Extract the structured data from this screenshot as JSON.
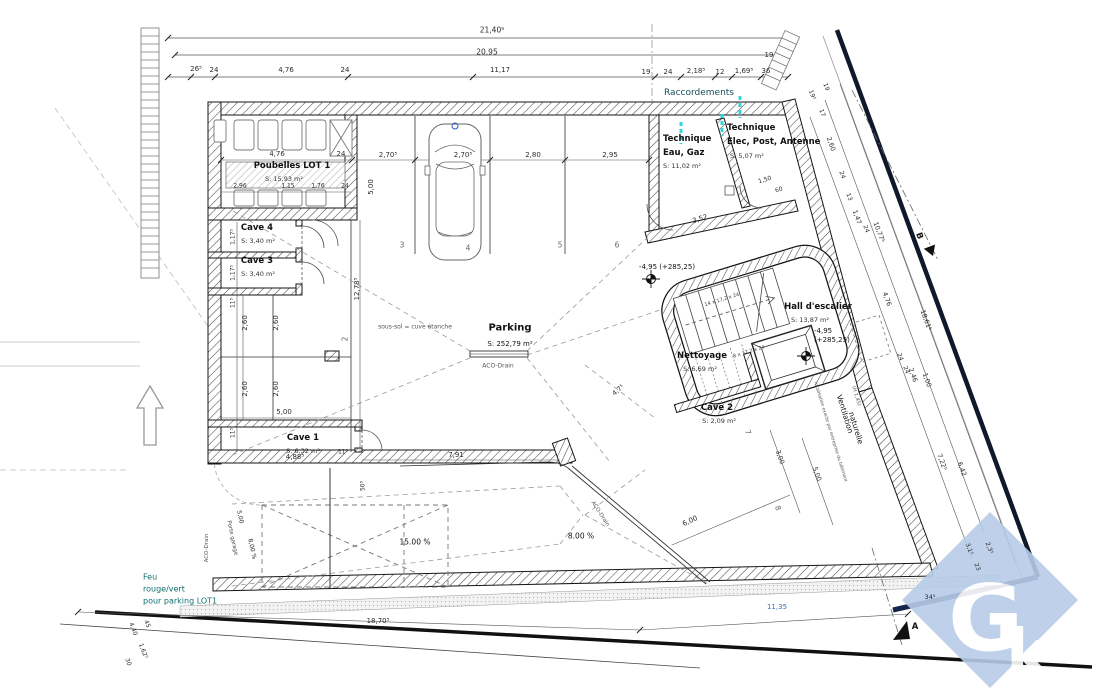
{
  "rooms": {
    "poubelles": {
      "name": "Poubelles LOT 1",
      "area": "S: 15,93 m²"
    },
    "cave4": {
      "name": "Cave 4",
      "area": "S: 3,40 m²"
    },
    "cave3": {
      "name": "Cave 3",
      "area": "S: 3,40 m²"
    },
    "cave1": {
      "name": "Cave 1",
      "area": "S: 6,32 m²"
    },
    "cave2": {
      "name": "Cave 2",
      "area": "S: 2,09 m²"
    },
    "parking": {
      "name": "Parking",
      "area": "S: 252,79 m²"
    },
    "technique_eau": {
      "name_line1": "Technique",
      "name_line2": "Eau, Gaz",
      "area": "S: 11,02 m²"
    },
    "technique_elec": {
      "name_line1": "Technique",
      "name_line2": "Elec, Post, Antenne",
      "area": "S: 5,07 m²"
    },
    "hall": {
      "name": "Hall d'escalier",
      "area": "S: 13,87 m²"
    },
    "nettoyage": {
      "name": "Nettoyage",
      "area": "S: 6,69 m²"
    }
  },
  "annotations": {
    "raccordements": "Raccordements",
    "feu_line1": "Feu",
    "feu_line2": "rouge/vert",
    "feu_line3": "pour parking LOT1",
    "sous_sol": "sous-sol = cuve étanche",
    "aco_drain": "ACO-Drain",
    "ventilation_line1": "Ventilation",
    "ventilation_line2": "naturelle",
    "ventilation_note": "localisation exacte par entreprise du bâtiment",
    "hauteur_note": "(H 1,45)",
    "porte_garage": "Porte garage",
    "stair_flight_upper": "14 x 17,2 x 24",
    "stair_flight_lower": "8 x 17,2 x 24",
    "level_left": "-4,95 (+285,25)",
    "level_right_line1": "-4,95",
    "level_right_line2": "(+285,25)",
    "slope_main": "15.00 %",
    "slope_secondary": "8.00 %",
    "section_a": "A",
    "section_b": "B"
  },
  "logo": {
    "letter1": "G",
    "letter2": "k",
    "color": "#b7cce8"
  },
  "colors": {
    "cyan_accent": "#35d3e0",
    "teal_text": "#0e6e6e",
    "dim_blue": "#3a6fae",
    "logo_blue": "#b7cce8"
  },
  "stall_numbers": [
    {
      "t": "2",
      "x": 345,
      "y": 339,
      "r": -90
    },
    {
      "t": "3",
      "x": 402,
      "y": 245
    },
    {
      "t": "4",
      "x": 468,
      "y": 248
    },
    {
      "t": "5",
      "x": 560,
      "y": 245
    },
    {
      "t": "6",
      "x": 617,
      "y": 245
    },
    {
      "t": "7",
      "x": 748,
      "y": 432,
      "r": 70
    },
    {
      "t": "8",
      "x": 778,
      "y": 508,
      "r": 70
    }
  ],
  "dim_labels": [
    {
      "t": "21,40⁵",
      "x": 492,
      "y": 30,
      "s": 7.5
    },
    {
      "t": "20,95",
      "x": 487,
      "y": 52,
      "s": 7.5
    },
    {
      "t": "19",
      "x": 769,
      "y": 55
    },
    {
      "t": "26⁵",
      "x": 196,
      "y": 69
    },
    {
      "t": "24",
      "x": 214,
      "y": 70
    },
    {
      "t": "4,76",
      "x": 286,
      "y": 70
    },
    {
      "t": "24",
      "x": 345,
      "y": 70
    },
    {
      "t": "11,17",
      "x": 500,
      "y": 70
    },
    {
      "t": "19",
      "x": 646,
      "y": 72
    },
    {
      "t": "24",
      "x": 668,
      "y": 72
    },
    {
      "t": "2,18⁵",
      "x": 696,
      "y": 71
    },
    {
      "t": "12",
      "x": 720,
      "y": 72
    },
    {
      "t": "1,69⁵",
      "x": 744,
      "y": 71
    },
    {
      "t": "36",
      "x": 766,
      "y": 71
    },
    {
      "t": "4,76",
      "x": 277,
      "y": 154
    },
    {
      "t": "24",
      "x": 341,
      "y": 154
    },
    {
      "t": "2,96",
      "x": 240,
      "y": 186,
      "s": 6
    },
    {
      "t": "1,15",
      "x": 288,
      "y": 186,
      "s": 6
    },
    {
      "t": "1,76",
      "x": 318,
      "y": 186,
      "s": 6
    },
    {
      "t": "24",
      "x": 345,
      "y": 186,
      "s": 6
    },
    {
      "t": "2,70⁵",
      "x": 388,
      "y": 155
    },
    {
      "t": "2,70⁵",
      "x": 463,
      "y": 155
    },
    {
      "t": "2,80",
      "x": 533,
      "y": 155
    },
    {
      "t": "2,95",
      "x": 610,
      "y": 155
    },
    {
      "t": "5,00",
      "x": 371,
      "y": 187,
      "r": -90
    },
    {
      "t": "12,78⁵",
      "x": 357,
      "y": 289,
      "r": -90
    },
    {
      "t": "1,17⁵",
      "x": 233,
      "y": 237,
      "r": -90,
      "s": 6
    },
    {
      "t": "1,17⁵",
      "x": 233,
      "y": 273,
      "r": -90,
      "s": 6
    },
    {
      "t": "11⁵",
      "x": 233,
      "y": 303,
      "r": -90,
      "s": 6
    },
    {
      "t": "2,60",
      "x": 245,
      "y": 323,
      "r": -90
    },
    {
      "t": "2,60",
      "x": 276,
      "y": 323,
      "r": -90
    },
    {
      "t": "2,60",
      "x": 245,
      "y": 389,
      "r": -90
    },
    {
      "t": "2,60",
      "x": 276,
      "y": 389,
      "r": -90
    },
    {
      "t": "5,00",
      "x": 284,
      "y": 412
    },
    {
      "t": "11⁵",
      "x": 233,
      "y": 433,
      "r": -90,
      "s": 6
    },
    {
      "t": "4,88⁵",
      "x": 295,
      "y": 457
    },
    {
      "t": "11⁵",
      "x": 343,
      "y": 452,
      "s": 6
    },
    {
      "t": "7,91",
      "x": 456,
      "y": 455
    },
    {
      "t": "50⁵",
      "x": 363,
      "y": 486,
      "r": -90,
      "s": 6
    },
    {
      "t": "3,52",
      "x": 700,
      "y": 219,
      "r": -17
    },
    {
      "t": "1,50",
      "x": 765,
      "y": 180,
      "r": -17,
      "s": 6
    },
    {
      "t": "60",
      "x": 779,
      "y": 190,
      "r": -17,
      "s": 6
    },
    {
      "t": "19⁵",
      "x": 812,
      "y": 95,
      "r": 70,
      "s": 6
    },
    {
      "t": "19",
      "x": 826,
      "y": 87,
      "r": 70,
      "s": 6
    },
    {
      "t": "17",
      "x": 822,
      "y": 113,
      "r": 70,
      "s": 6
    },
    {
      "t": "2,60",
      "x": 831,
      "y": 144,
      "r": 70,
      "s": 6.5
    },
    {
      "t": "24",
      "x": 842,
      "y": 175,
      "r": 70,
      "s": 6
    },
    {
      "t": "13",
      "x": 849,
      "y": 197,
      "r": 70,
      "s": 6
    },
    {
      "t": "1,47",
      "x": 857,
      "y": 217,
      "r": 70,
      "s": 6.5
    },
    {
      "t": "24",
      "x": 866,
      "y": 229,
      "r": 70,
      "s": 6
    },
    {
      "t": "10,77⁵",
      "x": 879,
      "y": 232,
      "r": 70,
      "s": 6.5
    },
    {
      "t": "4,76",
      "x": 887,
      "y": 299,
      "r": 70,
      "s": 6.5
    },
    {
      "t": "18,61⁵",
      "x": 926,
      "y": 320,
      "r": 70,
      "s": 6.5
    },
    {
      "t": "24",
      "x": 900,
      "y": 357,
      "r": 70,
      "s": 6
    },
    {
      "t": "24",
      "x": 906,
      "y": 370,
      "r": 70,
      "s": 6
    },
    {
      "t": "2,46",
      "x": 913,
      "y": 375,
      "r": 70,
      "s": 6.5
    },
    {
      "t": "1,00",
      "x": 927,
      "y": 380,
      "r": 70,
      "s": 6.5
    },
    {
      "t": "7,22⁵",
      "x": 942,
      "y": 462,
      "r": 70,
      "s": 6.5
    },
    {
      "t": "6,42",
      "x": 962,
      "y": 469,
      "r": 70,
      "s": 6.5
    },
    {
      "t": "3,1⁵",
      "x": 969,
      "y": 549,
      "r": 70,
      "s": 6
    },
    {
      "t": "2,3⁵",
      "x": 989,
      "y": 548,
      "r": 70,
      "s": 6
    },
    {
      "t": "23",
      "x": 977,
      "y": 567,
      "r": 70,
      "s": 6
    },
    {
      "t": "34⁵",
      "x": 930,
      "y": 597,
      "s": 6.5
    },
    {
      "t": "18,70⁵",
      "x": 378,
      "y": 621
    },
    {
      "t": "11,35",
      "x": 777,
      "y": 607,
      "c": "b"
    },
    {
      "t": "6,00",
      "x": 690,
      "y": 521,
      "r": -25
    },
    {
      "t": "3,00",
      "x": 780,
      "y": 457,
      "r": 70,
      "s": 6.5
    },
    {
      "t": "5,00",
      "x": 817,
      "y": 474,
      "r": 70,
      "s": 6.5
    },
    {
      "t": "4,7⁵",
      "x": 618,
      "y": 390,
      "r": -40,
      "s": 6.5
    },
    {
      "t": "4,40",
      "x": 133,
      "y": 629,
      "r": 70,
      "s": 6
    },
    {
      "t": "45",
      "x": 147,
      "y": 624,
      "r": 70,
      "s": 6
    },
    {
      "t": "1,62⁵",
      "x": 143,
      "y": 651,
      "r": 70,
      "s": 6
    },
    {
      "t": "30",
      "x": 128,
      "y": 662,
      "r": 70,
      "s": 6
    },
    {
      "t": "5,00",
      "x": 240,
      "y": 517,
      "r": 78,
      "s": 6
    },
    {
      "t": "8,00 %",
      "x": 252,
      "y": 549,
      "r": 78,
      "s": 6
    }
  ]
}
